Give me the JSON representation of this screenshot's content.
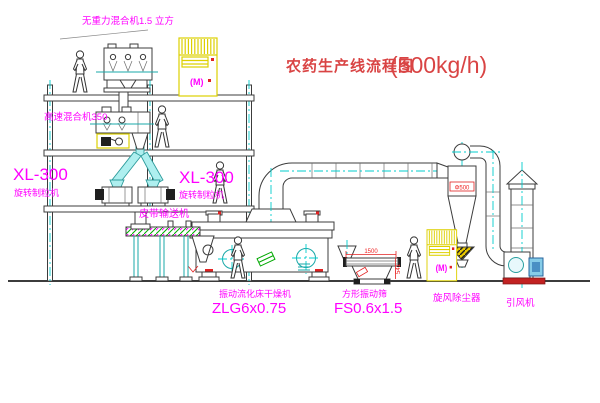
{
  "title": {
    "text": "农药生产线流程图",
    "capacity": "(500kg/h)"
  },
  "labels": {
    "gravity_mixer": "无重力混合机1.5 立方",
    "high_speed_mixer": "高速混合机350",
    "granulator_model_left": "XL-300",
    "granulator_name_left": "旋转制粒机",
    "granulator_model_right": "XL-300",
    "granulator_name_right": "旋转制粒机",
    "belt_conveyor": "皮带输送机",
    "dryer_name": "振动流化床干燥机",
    "dryer_model": "ZLG6x0.75",
    "screen_name": "方形振动筛",
    "screen_model": "FS0.6x1.5",
    "cyclone": "旋风除尘器",
    "fan": "引风机",
    "elevator_badge": "(M)"
  },
  "dimensions": {
    "screen_length": "1500",
    "screen_height": "541",
    "cyclone_note": "Φ500"
  },
  "colors": {
    "label_magenta": "#ff00ff",
    "title_red": "#d94444",
    "dimension_red": "#ee2222",
    "equipment_yellow": "#ddd000",
    "centerline_cyan": "#00cccc",
    "chute_fill_cyan": "#aeefef",
    "belt_green": "#00a800",
    "line_dark": "#3c3c3c"
  }
}
